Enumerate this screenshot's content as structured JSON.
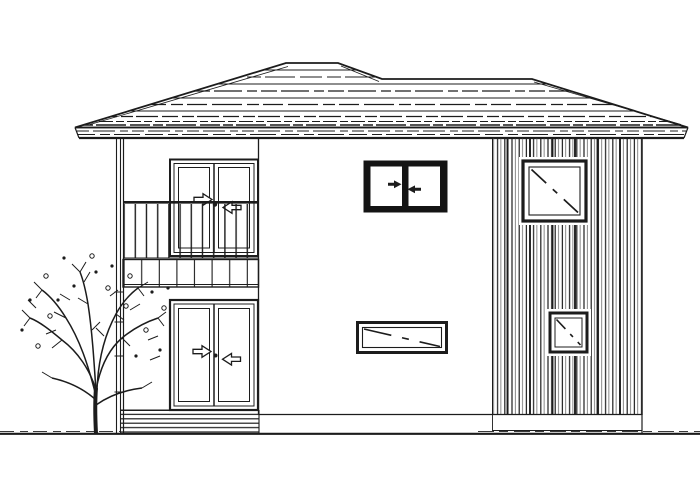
{
  "colors": {
    "ink": "#1c1c1c",
    "ink_soft": "#565656",
    "paper": "#ffffff",
    "frame_dark": "#141414"
  },
  "scene": {
    "type": "architectural-elevation-line-drawing",
    "building": "two-story-house-side-elevation",
    "components": [
      {
        "name": "hipped-roof",
        "texture": "horizontal-roofing-courses",
        "eaves": "full-width-fascia-band"
      },
      {
        "name": "left-wing",
        "features": [
          "balcony-railing-vertical-balusters",
          "balcony-fascia-panel",
          "downspout"
        ]
      },
      {
        "name": "balcony-sliding-door",
        "floor": 2,
        "symbol": "two-outline-arrows-pointing-inward"
      },
      {
        "name": "ground-floor-sliding-door",
        "floor": 1,
        "symbol": "two-outline-arrows-pointing-inward"
      },
      {
        "name": "deck-step-band",
        "texture": "horizontal-slats"
      },
      {
        "name": "upper-middle-sliding-window",
        "floor": 2,
        "frame": "heavy-black",
        "symbol": "two-filled-arrows-pointing-inward"
      },
      {
        "name": "lower-middle-awning-window",
        "floor": 1,
        "symbol": "dashed-diagonal"
      },
      {
        "name": "right-siding-section",
        "texture": "vertical-board-siding"
      },
      {
        "name": "upper-right-window",
        "floor": 2,
        "symbol": "dashed-diagonal"
      },
      {
        "name": "lower-right-window",
        "floor": 1,
        "symbol": "dashed-diagonal"
      },
      {
        "name": "bare-tree",
        "details": "branches-twigs-scattered-berry-dots"
      },
      {
        "name": "ground-line"
      }
    ]
  }
}
